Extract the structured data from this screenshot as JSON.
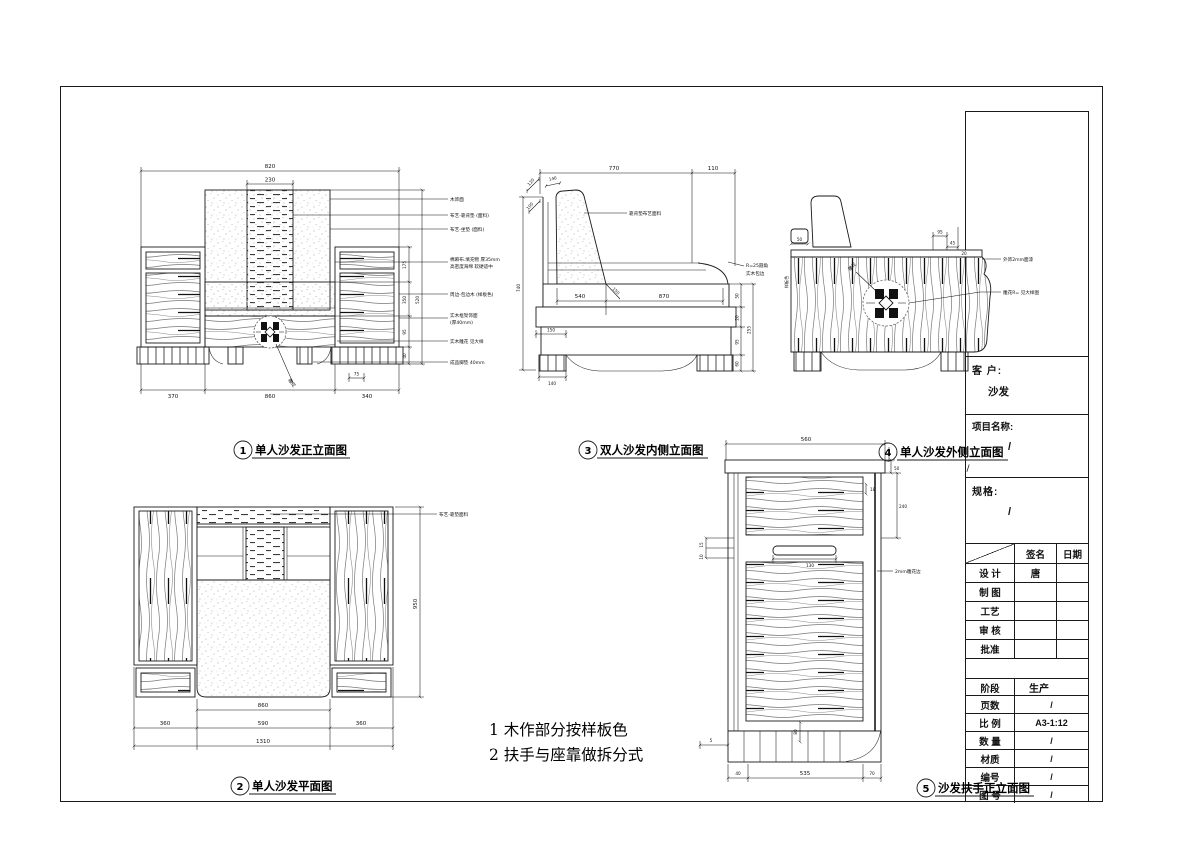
{
  "colors": {
    "line": "#1a1a1a",
    "grain": "#6b6b6b",
    "paper": "#ffffff"
  },
  "captions": {
    "c1": {
      "num": "1",
      "label": "单人沙发正立面图"
    },
    "c2": {
      "num": "2",
      "label": "单人沙发平面图"
    },
    "c3": {
      "num": "3",
      "label": "双人沙发内侧立面图"
    },
    "c4": {
      "num": "4",
      "label": "单人沙发外侧立面图",
      "suffix": "/"
    },
    "c5": {
      "num": "5",
      "label": "沙发扶手正立面图"
    }
  },
  "notes": {
    "line1": "1 木作部分按样板色",
    "line2": "2 扶手与座靠做拆分式"
  },
  "titleblock": {
    "client_label": "客 户:",
    "client_value": "沙发",
    "project_label": "项目名称:",
    "project_value": "/",
    "spec_label": "规格:",
    "spec_value": "/",
    "sign_col": "签名",
    "date_col": "日期",
    "rows": [
      {
        "label": "设 计",
        "sign": "唐",
        "date": ""
      },
      {
        "label": "制 图",
        "sign": "",
        "date": ""
      },
      {
        "label": "工艺",
        "sign": "",
        "date": ""
      },
      {
        "label": "审 核",
        "sign": "",
        "date": ""
      },
      {
        "label": "批准",
        "sign": "",
        "date": ""
      }
    ],
    "stage_label": "阶段",
    "stage_value": "生产",
    "info_rows": [
      {
        "label": "页数",
        "value": "/"
      },
      {
        "label": "比 例",
        "value": "A3-1:12"
      },
      {
        "label": "数 量",
        "value": "/"
      },
      {
        "label": "材质",
        "value": "/"
      },
      {
        "label": "编号",
        "value": "/"
      },
      {
        "label": "图 号",
        "value": "/"
      }
    ]
  },
  "d1": {
    "dim_total_w": "820",
    "dim_back_w": "230",
    "dim_b1": "370",
    "dim_b2": "860",
    "dim_b3": "340",
    "dim_b4": "75",
    "dim_r1": "175",
    "dim_r2": "350",
    "dim_r3": "95",
    "dim_r4": "40",
    "dim_r5": "520",
    "carve_label": "雕花",
    "ann1": "木饰面",
    "ann2": "布艺-靠背垫 (面料)",
    "ann3": "布艺-坐垫 (面料)",
    "ann4a": "棉麻布.填充物 厚35mm",
    "ann4b": "高密度海绵 软硬适中",
    "ann5": "周边-包边木 (样板色)",
    "ann6a": "实木框架饰面",
    "ann6b": "(厚40mm)",
    "ann7": "实木雕花 见大样",
    "ann8": "成品脚垫 40mm"
  },
  "d3": {
    "dim_t1": "770",
    "dim_t2": "110",
    "dim_a1": "120",
    "dim_a2": "140",
    "dim_l1": "100",
    "dim_l2": "740",
    "dim_s1": "540",
    "dim_s2": "870",
    "dim_s3": "150",
    "dim_b1": "150",
    "dim_b2": "140",
    "dim_r1": "50",
    "dim_r2": "20",
    "dim_r3": "95",
    "dim_r4": "60",
    "dim_r5": "255",
    "ann1": "靠背垫布艺面料",
    "ann2a": "R=25圆角",
    "ann2b": "实木包边"
  },
  "d4": {
    "dim1": "50",
    "dim2": "95",
    "dim3": "45",
    "dim4": "20",
    "ann1": "外饰2mm面漆",
    "ann2": "雕花R= 见大样图",
    "ann3": "雕花",
    "ann4": "样板色"
  },
  "d2": {
    "dim_r": "950",
    "dim_b1": "860",
    "dim_b2": "360",
    "dim_b3": "590",
    "dim_b4": "360",
    "dim_b5": "1310",
    "ann1": "布艺-靠垫面料"
  },
  "d5": {
    "dim_t": "560",
    "dim_r1": "50",
    "dim_r2": "240",
    "dim_r3": "18",
    "dim_l1": "15",
    "dim_l2": "10",
    "dim_l3": "5",
    "dim_m1": "130",
    "dim_m2": "80",
    "dim_b1": "40",
    "dim_b2": "535",
    "dim_b3": "70",
    "ann1": "2mm雕花边"
  }
}
